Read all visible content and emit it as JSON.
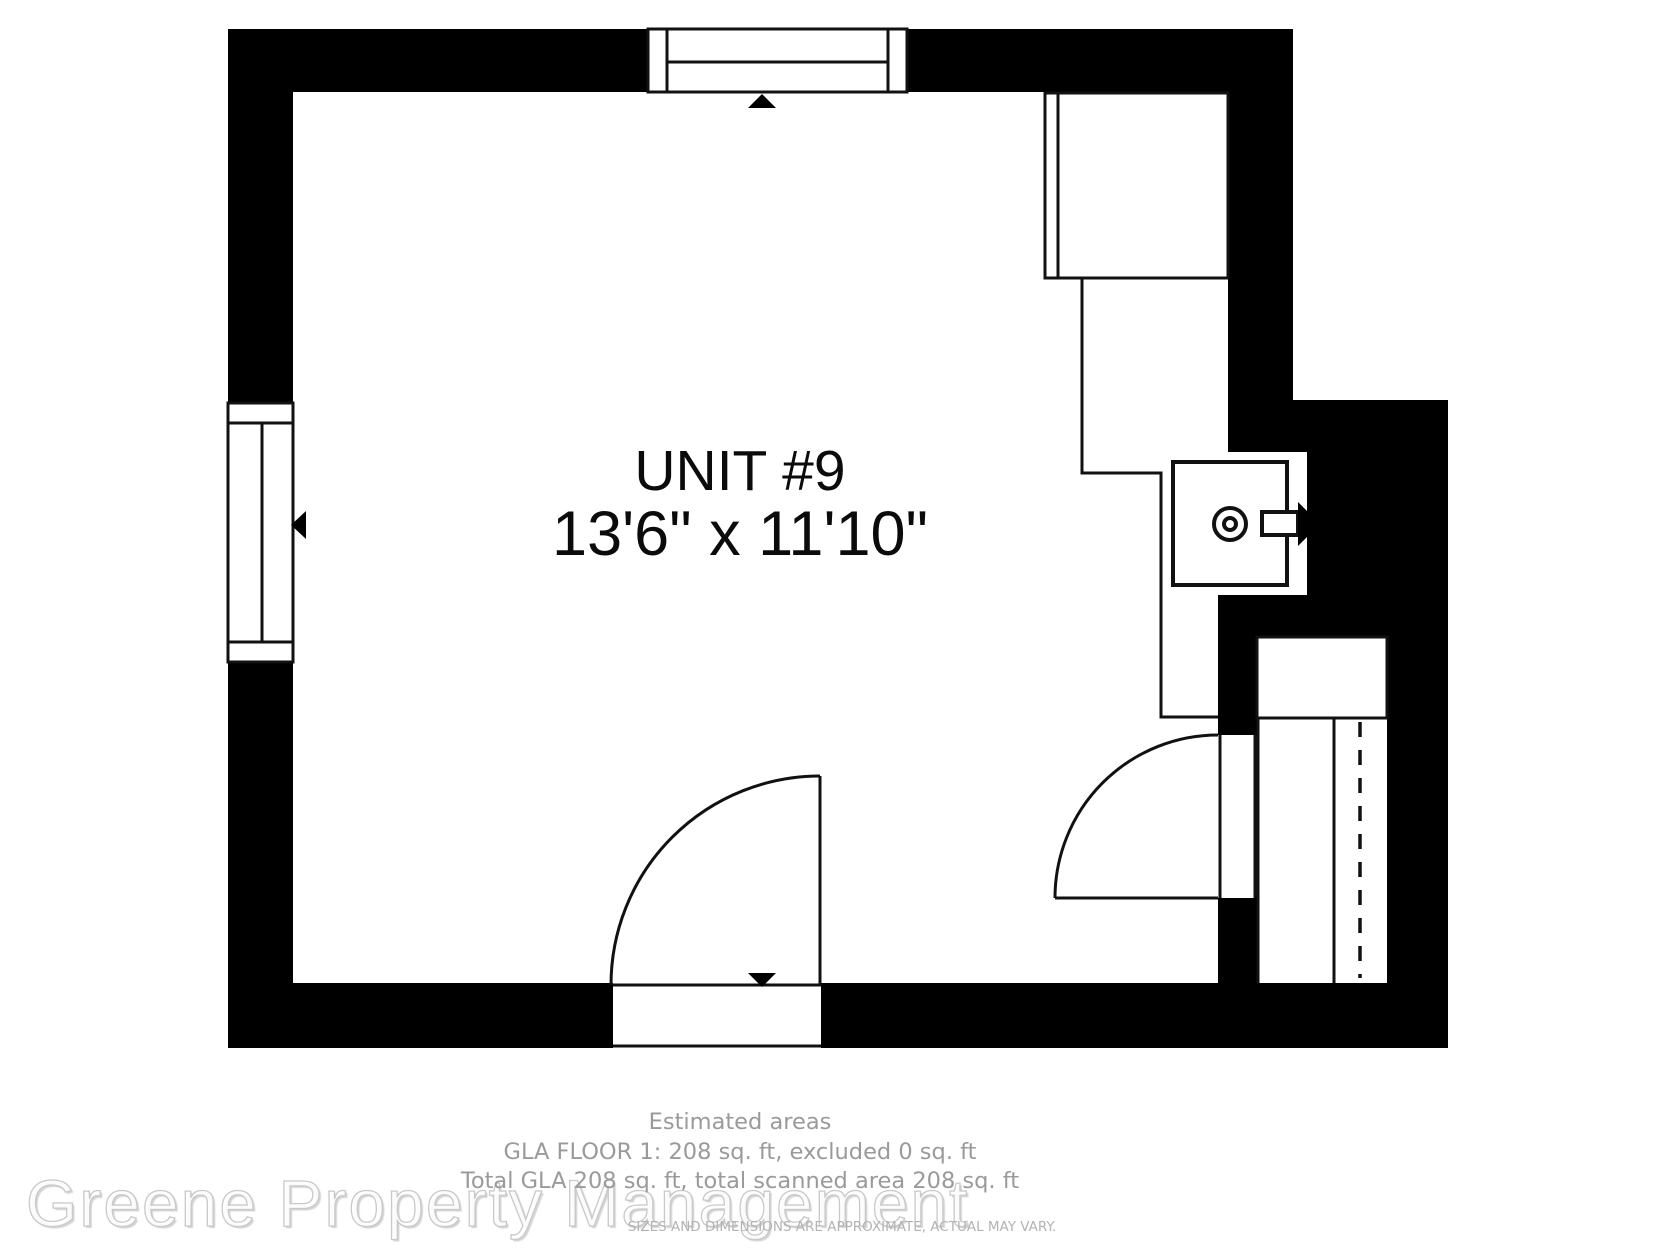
{
  "floorplan": {
    "unit_label": "UNIT #9",
    "unit_dimensions": "13'6\" x 11'10\"",
    "footer": {
      "title": "Estimated areas",
      "gla_line": "GLA FLOOR 1: 208 sq. ft, excluded 0 sq. ft",
      "total_line": "Total GLA 208 sq. ft, total scanned area 208 sq. ft",
      "disclaimer": "SIZES AND DIMENSIONS ARE APPROXIMATE, ACTUAL MAY VARY."
    },
    "watermark": "Greene Property Management",
    "colors": {
      "wall": "#000000",
      "line": "#111111",
      "footer_text": "#9a9a9a",
      "disclaimer_text": "#b3b3b3",
      "watermark_outline": "#c9c9c9"
    },
    "symbols": [
      "top-window",
      "left-window",
      "entry-door-bottom",
      "interior-door-right",
      "wardrobe-cabinet",
      "kitchen-counter-outline",
      "water-heater-with-vent-arrow",
      "closet-with-hanging-rod",
      "direction-triangles"
    ]
  }
}
